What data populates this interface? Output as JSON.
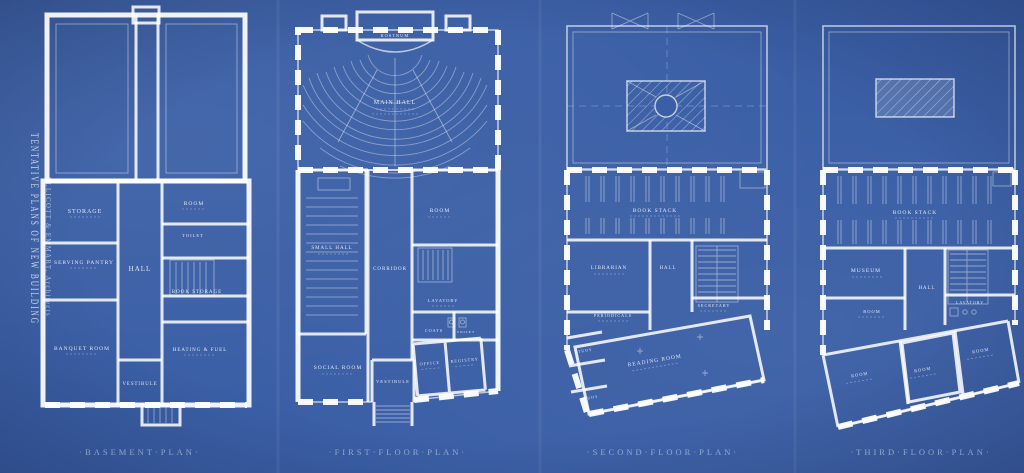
{
  "canvas": {
    "background": "#3b5fa6",
    "line_color": "#ffffff"
  },
  "sidebar_title": {
    "main": "TENTATIVE PLANS OF NEW BUILDING",
    "sub": "ELLICOTT & EMMART, Architects"
  },
  "plans": {
    "basement": {
      "caption": "·BASEMENT·PLAN·",
      "rooms": {
        "storage": "STORAGE",
        "room": "ROOM",
        "serving_pantry": "SERVING PANTRY",
        "hall": "HALL",
        "toilet": "TOILET",
        "book_storage": "BOOK STORAGE",
        "banquet_room": "BANQUET ROOM",
        "heating_fuel": "HEATING & FUEL",
        "vestibule": "VESTIBULE"
      }
    },
    "first_floor": {
      "caption": "·FIRST·FLOOR·PLAN·",
      "rooms": {
        "rostrum": "ROSTRUM",
        "main_hall": "MAIN HALL",
        "small_hall": "SMALL HALL",
        "corridor": "CORRIDOR",
        "room": "ROOM",
        "lavatory": "LAVATORY",
        "coats": "COATS",
        "toilet": "TOILET",
        "social_room": "SOCIAL ROOM",
        "vestibule": "VESTIBULE",
        "office": "OFFICE",
        "registry": "REGISTRY"
      }
    },
    "second_floor": {
      "caption": "·SECOND·FLOOR·PLAN·",
      "rooms": {
        "book_stack": "BOOK STACK",
        "librarian": "LIBRARIAN",
        "hall": "HALL",
        "secretary": "SECRETARY",
        "periodicals": "PERIODICALS",
        "study_1": "STUDY",
        "study_2": "STUDY",
        "reading_room": "READING ROOM"
      }
    },
    "third_floor": {
      "caption": "·THIRD·FLOOR·PLAN·",
      "rooms": {
        "book_stack": "BOOK STACK",
        "museum": "MUSEUM",
        "hall": "HALL",
        "lavatory": "LAVATORY",
        "room_1": "ROOM",
        "room_2": "ROOM",
        "room_3": "ROOM",
        "room_4": "ROOM"
      }
    }
  }
}
